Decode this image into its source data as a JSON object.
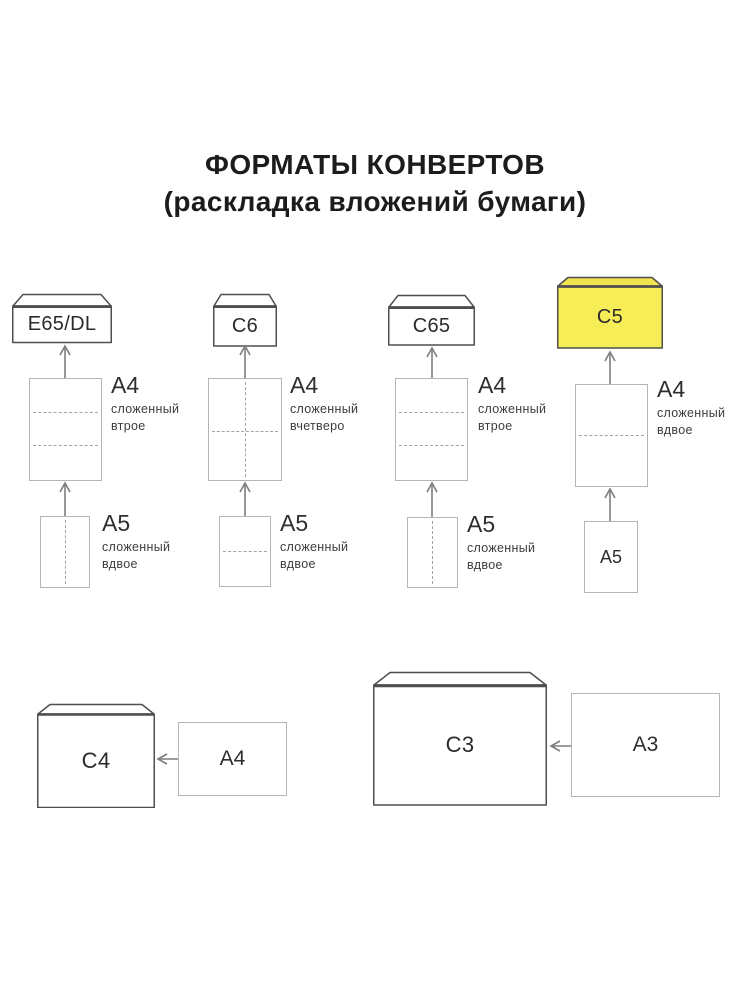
{
  "title": {
    "line1": "ФОРМАТЫ КОНВЕРТОВ",
    "line2": "(раскладка вложений бумаги)"
  },
  "colors": {
    "highlight": "#f7ed57",
    "highlight_flap": "#f2e44e",
    "envelope_line": "#4f4f4f",
    "sheet_line": "#b5b5b5",
    "arrow": "#7d7d7d",
    "text": "#2e2e2e"
  },
  "columns": [
    {
      "envelope_label": "E65/DL",
      "insert1": {
        "label": "A4",
        "sub1": "сложенный",
        "sub2": "втрое"
      },
      "insert2": {
        "label": "A5",
        "sub1": "сложенный",
        "sub2": "вдвое"
      }
    },
    {
      "envelope_label": "C6",
      "insert1": {
        "label": "A4",
        "sub1": "сложенный",
        "sub2": "вчетверо"
      },
      "insert2": {
        "label": "A5",
        "sub1": "сложенный",
        "sub2": "вдвое"
      }
    },
    {
      "envelope_label": "C65",
      "insert1": {
        "label": "A4",
        "sub1": "сложенный",
        "sub2": "втрое"
      },
      "insert2": {
        "label": "A5",
        "sub1": "сложенный",
        "sub2": "вдвое"
      }
    },
    {
      "envelope_label": "C5",
      "insert1": {
        "label": "A4",
        "sub1": "сложенный",
        "sub2": "вдвое"
      },
      "insert2": {
        "label": "A5"
      }
    }
  ],
  "bottom_row": [
    {
      "envelope_label": "C4",
      "insert_label": "A4"
    },
    {
      "envelope_label": "C3",
      "insert_label": "A3"
    }
  ]
}
